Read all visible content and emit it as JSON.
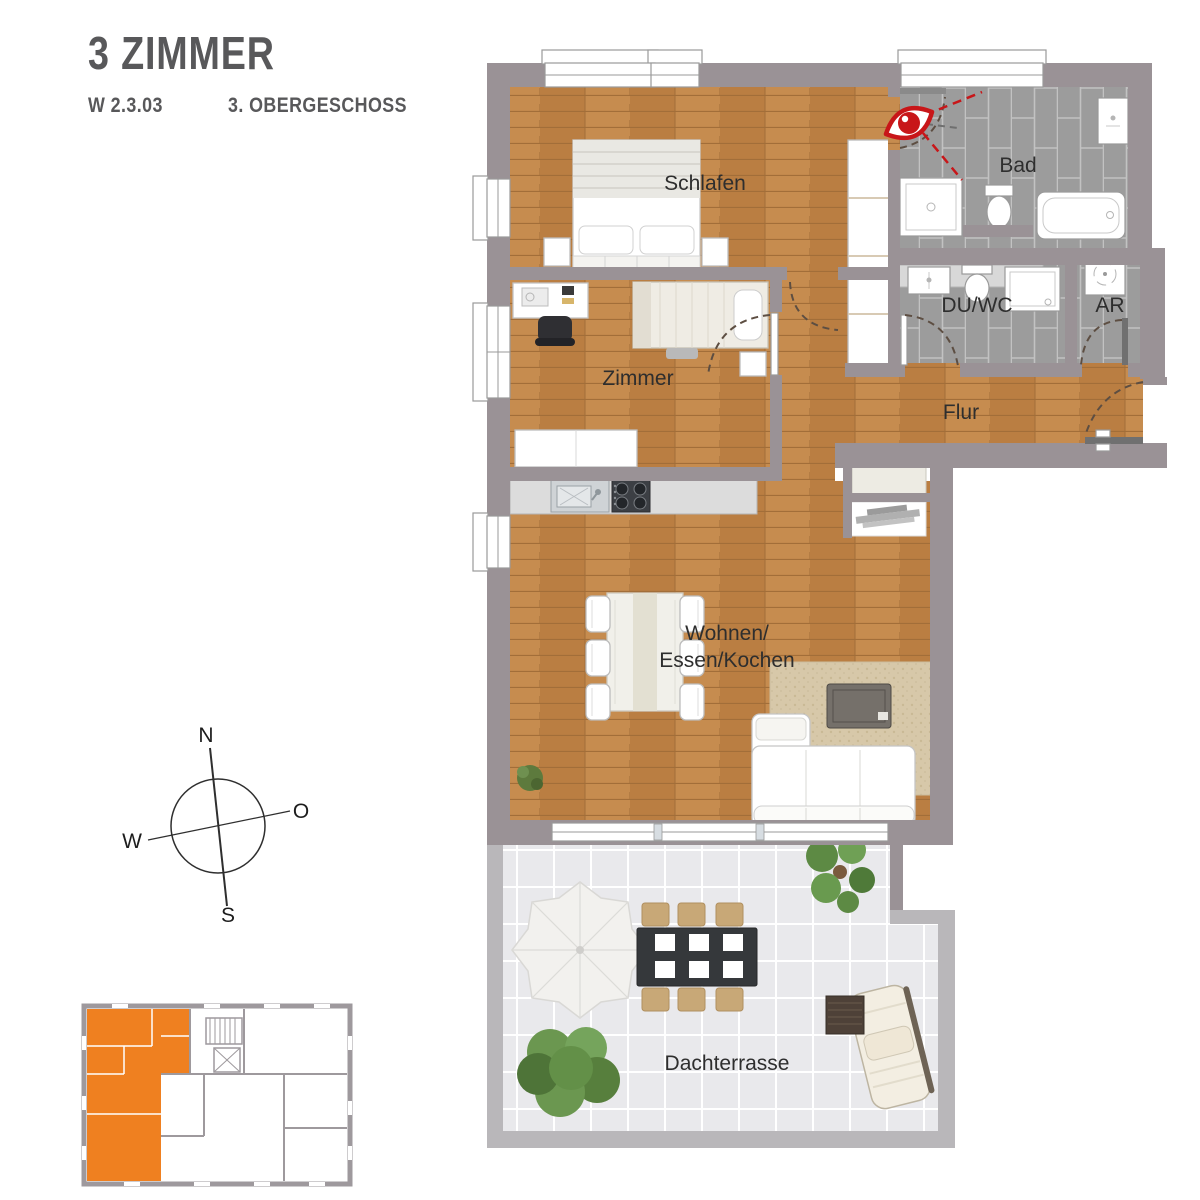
{
  "header": {
    "title": "3 ZIMMER",
    "unit_code": "W 2.3.03",
    "floor_label": "3. OBERGESCHOSS"
  },
  "floorplan": {
    "rooms": [
      {
        "id": "schlafen",
        "label": "Schlafen"
      },
      {
        "id": "zimmer",
        "label": "Zimmer"
      },
      {
        "id": "bad",
        "label": "Bad"
      },
      {
        "id": "du-wc",
        "label": "DU/WC"
      },
      {
        "id": "ar",
        "label": "AR"
      },
      {
        "id": "flur",
        "label": "Flur"
      },
      {
        "id": "wohnen-essen-kochen",
        "label_line1": "Wohnen/",
        "label_line2": "Essen/Kochen"
      },
      {
        "id": "dachterrasse",
        "label": "Dachterrasse"
      }
    ],
    "icons": {
      "viewpoint": "panorama-viewpoint-icon"
    }
  },
  "compass": {
    "north": "N",
    "east": "O",
    "south": "S",
    "west": "W"
  },
  "keyplan": {
    "highlight_color": "#ef8020"
  },
  "colors": {
    "wall": "#9a9296",
    "wood_floor": "#c08449",
    "tile_floor": "#9c9c9c",
    "terrace_floor": "#e9e9ec",
    "parapet": "#b9b7ba",
    "unit_highlight": "#ef8020",
    "viewpoint_red": "#c81619",
    "title_text": "#58585a",
    "label_text": "#2e2e2e"
  }
}
